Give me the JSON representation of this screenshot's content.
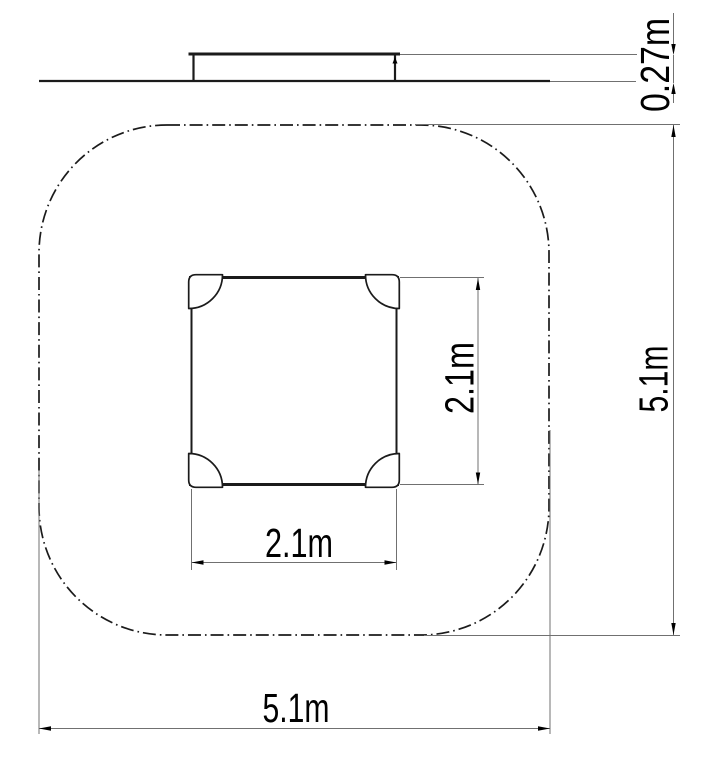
{
  "drawing": {
    "colors": {
      "background": "#ffffff",
      "object_line": "#1b1b1b",
      "dimension_line": "#707070",
      "text": "#000000"
    },
    "dimensions": {
      "platform_height": "0.27m",
      "platform_depth": "2.1m",
      "platform_width": "2.1m",
      "safety_zone_depth": "5.1m",
      "safety_zone_width": "5.1m"
    }
  }
}
